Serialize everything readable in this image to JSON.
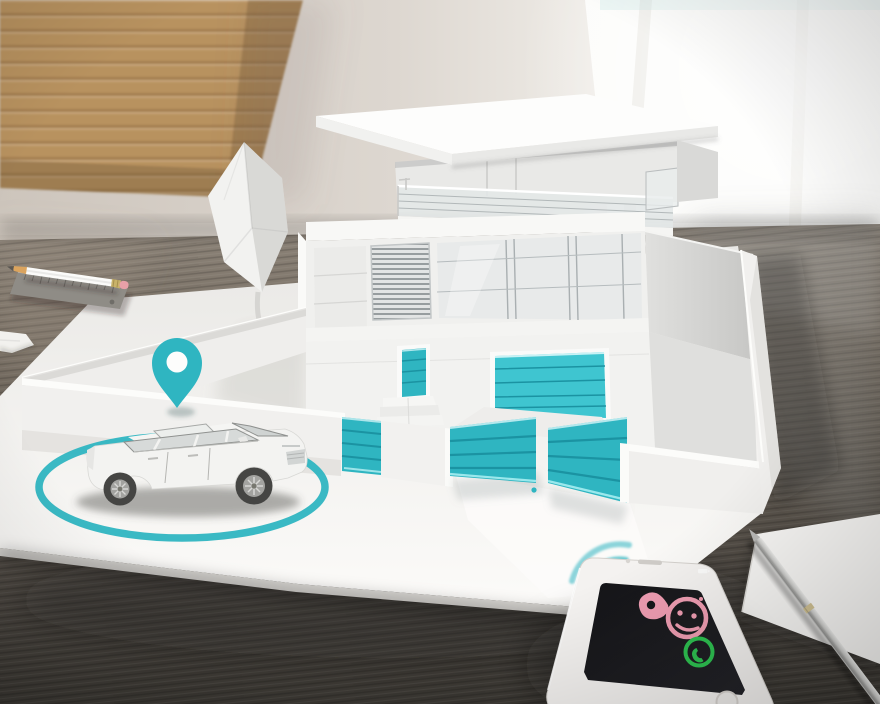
{
  "scene": {
    "type": "3d-render-photo",
    "description": "Smart-home concept: white architectural model house with teal gates on a wooden desk; white car with GPS pin and tracking ring; smartphone showing an incoming call; wifi waves between phone and gate",
    "objects": [
      "wood-wall-panel",
      "bright-window",
      "wooden-desk",
      "model-base-board",
      "low-poly-tree",
      "model-house",
      "flat-roof",
      "balcony-railing",
      "louver-panel",
      "window-panels",
      "front-door",
      "garage-door",
      "entrance-steps",
      "perimeter-fence",
      "pedestrian-gate",
      "driveway-gate-left",
      "driveway-gate-right",
      "white-car",
      "gps-ring",
      "location-pin",
      "wifi-waves",
      "smartphone",
      "incoming-call-screen",
      "paper-sheet",
      "silver-pen",
      "ruler",
      "pencil",
      "eraser-block"
    ]
  },
  "colors": {
    "teal": "#2fb5c1",
    "teal_bright": "#3fc5d0",
    "teal_dark": "#1b93a2",
    "pink": "#ef9db2",
    "green": "#2ec151",
    "screen": "#17171a",
    "wood_desk": "#6b655c",
    "wood_panel": "#b8925f",
    "wall": "#d8d2cb",
    "model_white": "#f2f1ef"
  },
  "phone": {
    "status_icon": "battery-icon",
    "avatar_icon": "girl-face-icon",
    "call_icon": "phone-handset-icon",
    "home_button": "home-button"
  }
}
